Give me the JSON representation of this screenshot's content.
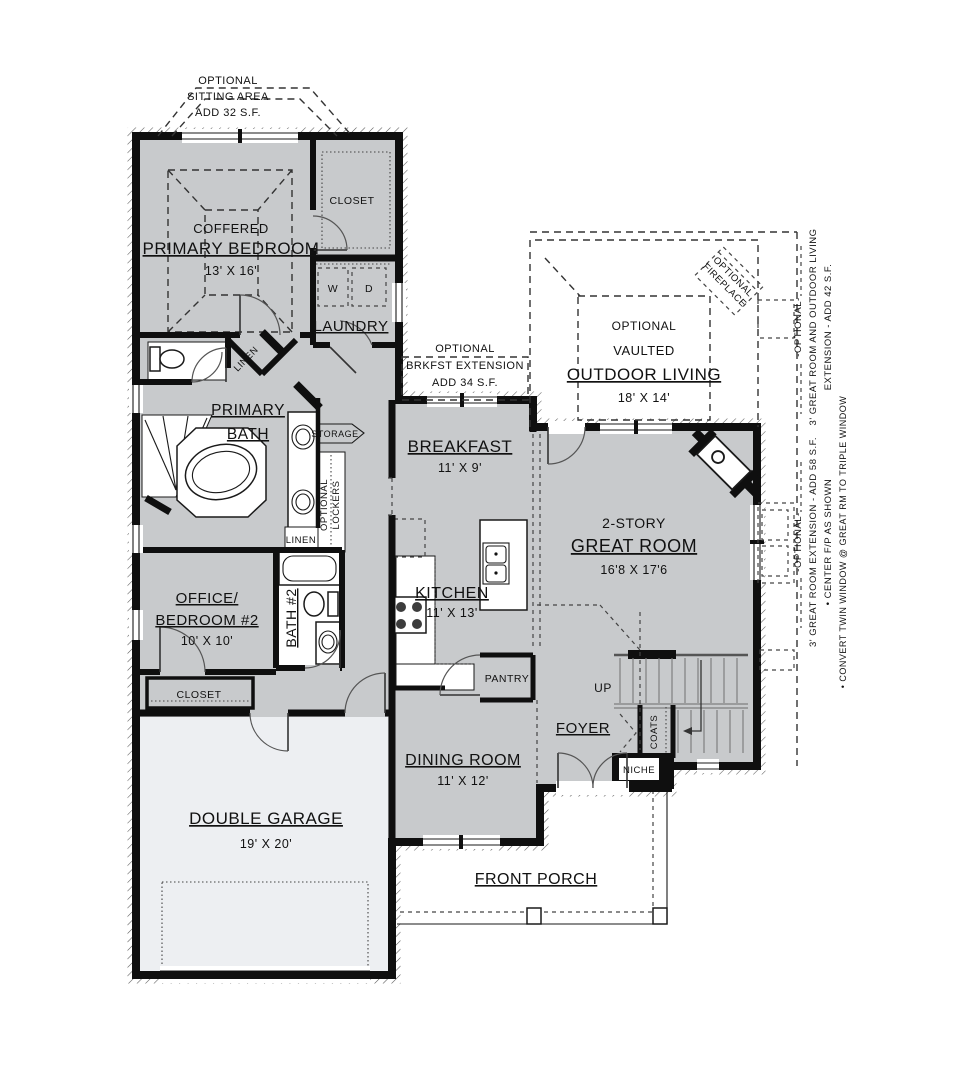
{
  "rooms": {
    "primary_bedroom": {
      "sub": "COFFERED",
      "name": "PRIMARY BEDROOM",
      "dims": "13' X 16'"
    },
    "primary_closet": {
      "name": "CLOSET"
    },
    "laundry": {
      "name": "LAUNDRY",
      "washer": "W",
      "dryer": "D"
    },
    "primary_bath": {
      "name1": "PRIMARY",
      "name2": "BATH"
    },
    "linen_bath": {
      "name": "LINEN"
    },
    "linen_hall": {
      "name": "LINEN"
    },
    "storage": {
      "name": "STORAGE"
    },
    "lockers": {
      "word1": "OPTIONAL",
      "word2": "LOCKERS"
    },
    "office": {
      "name1": "OFFICE/",
      "name2": "BEDROOM #2",
      "dims": "10' X 10'"
    },
    "bath2": {
      "name": "BATH #2"
    },
    "office_closet": {
      "name": "CLOSET"
    },
    "garage": {
      "name": "DOUBLE GARAGE",
      "dims": "19' X 20'"
    },
    "breakfast": {
      "name": "BREAKFAST",
      "dims": "11' X 9'"
    },
    "kitchen": {
      "name": "KITCHEN",
      "dims": "11' X 13'"
    },
    "pantry": {
      "name": "PANTRY"
    },
    "dining": {
      "name": "DINING ROOM",
      "dims": "11' X 12'"
    },
    "great_room": {
      "sub": "2-STORY",
      "name": "GREAT ROOM",
      "dims": "16'8 X 17'6"
    },
    "foyer": {
      "name": "FOYER"
    },
    "stairs": {
      "up": "UP"
    },
    "coats": {
      "name": "COATS"
    },
    "niche": {
      "name": "NICHE"
    },
    "front_porch": {
      "name": "FRONT PORCH"
    },
    "outdoor_living": {
      "sub1": "OPTIONAL",
      "sub2": "VAULTED",
      "name": "OUTDOOR LIVING",
      "dims": "18' X 14'"
    }
  },
  "options": {
    "sitting_area": {
      "line1": "OPTIONAL",
      "line2": "SITTING AREA",
      "line3": "ADD 32 S.F."
    },
    "breakfast_extension": {
      "line1": "OPTIONAL",
      "line2": "BRKFST EXTENSION",
      "line3": "ADD 34 S.F."
    },
    "fireplace": {
      "line1": "OPTIONAL",
      "line2": "FIREPLACE"
    },
    "great_room_outdoor_extension": {
      "title": "-OPTIONAL-",
      "line1": "3' GREAT ROOM AND OUTDOOR LIVING",
      "line2": "EXTENSION - ADD 42 S.F."
    },
    "great_room_extension": {
      "title": "-OPTIONAL-",
      "line1": "3' GREAT ROOM EXTENSION - ADD 58 S.F.",
      "line2": "• CENTER F/P AS SHOWN",
      "line3": "• CONVERT TWIN WINDOW @ GREAT RM TO TRIPLE WINDOW"
    }
  },
  "colors": {
    "wall": "#0f0f0f",
    "floor": "#c8cacc",
    "garage_floor": "#edeff2",
    "background": "#ffffff"
  }
}
